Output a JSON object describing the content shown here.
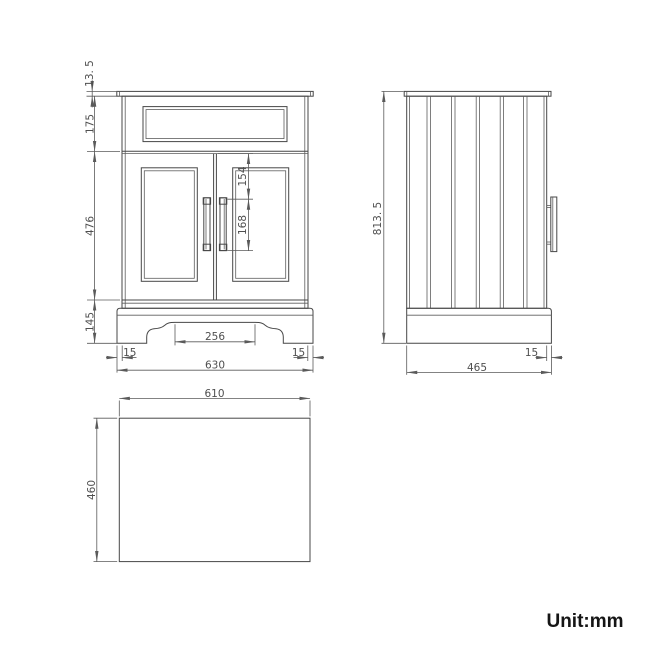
{
  "unit_label": "Unit:mm",
  "colors": {
    "background": "#ffffff",
    "drawing_line": "#474747",
    "dimension_line": "#5a5a5a",
    "dimension_text": "#4f4f4f",
    "unit_text": "#151515"
  },
  "dims": {
    "front": {
      "counter_thickness": "13. 5",
      "upper_section_height": "175",
      "door_section_height": "476",
      "plinth_height": "145",
      "handle_top_offset": "154",
      "handle_length": "168",
      "cutout_width": "256",
      "left_overhang": "15",
      "right_overhang": "15",
      "overall_width": "630"
    },
    "side": {
      "overall_height": "813. 5",
      "overall_depth": "465",
      "front_overhang": "15"
    },
    "top": {
      "width": "610",
      "depth": "460"
    }
  }
}
